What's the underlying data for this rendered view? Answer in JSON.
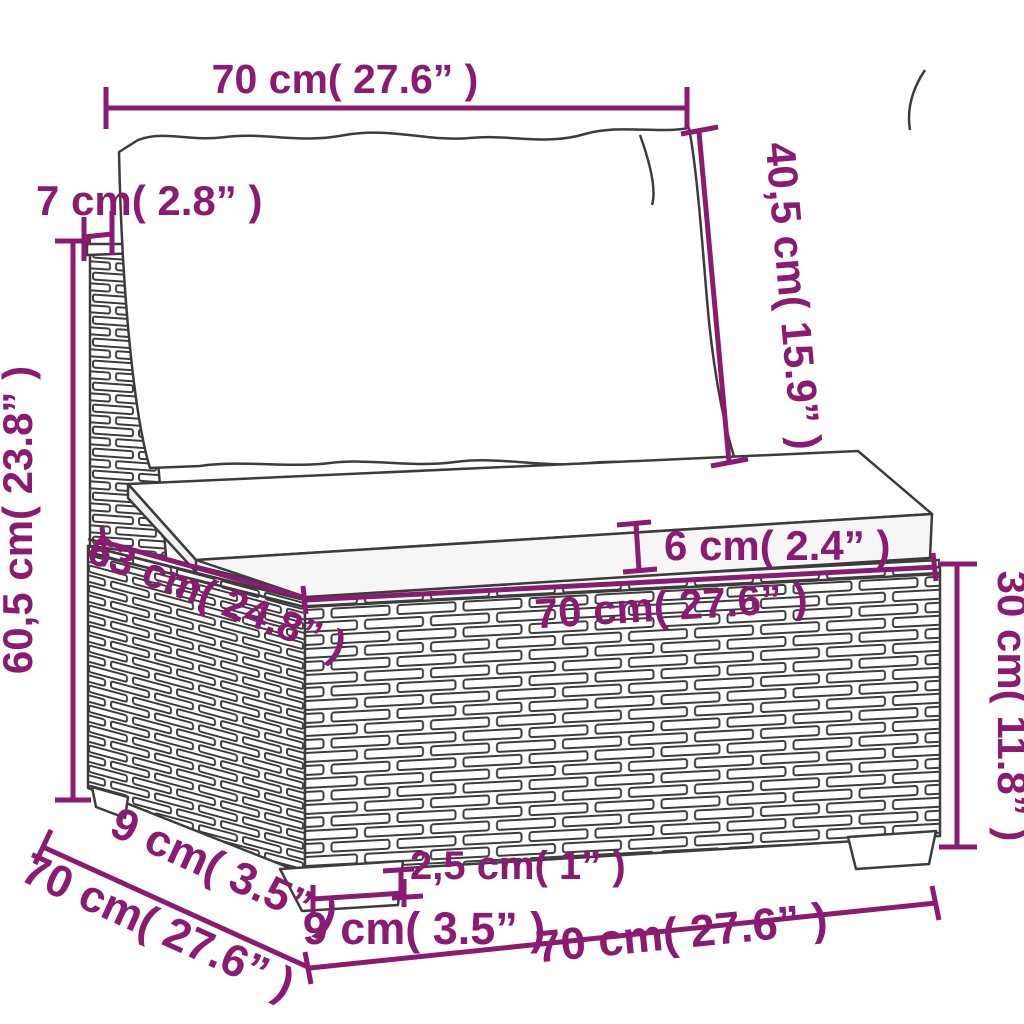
{
  "diagram": {
    "type": "furniture-dimension-diagram",
    "subject": "poly rattan garden sofa middle section with back and seat cushions",
    "accent_color": "#8a1b70",
    "outline_color": "#3c3c3c",
    "dimensions": {
      "back_width_top": "70 cm( 27.6” )",
      "back_cushion_height": "40,5 cm( 15.9” )",
      "back_frame_thickness": "7 cm( 2.8” )",
      "total_height": "60,5 cm( 23.8” )",
      "seat_cushion_thickness": "6 cm( 2.4” )",
      "seat_depth": "63 cm( 24.8” )",
      "seat_width": "70 cm( 27.6” )",
      "base_height": "30 cm( 11.8” )",
      "leg_depth": "9 cm( 3.5” )",
      "overall_depth": "70 cm( 27.6” )",
      "leg_width": "9 cm( 3.5” )",
      "leg_height": "2,5 cm( 1” )",
      "base_width_bottom": "70 cm( 27.6” )"
    }
  }
}
